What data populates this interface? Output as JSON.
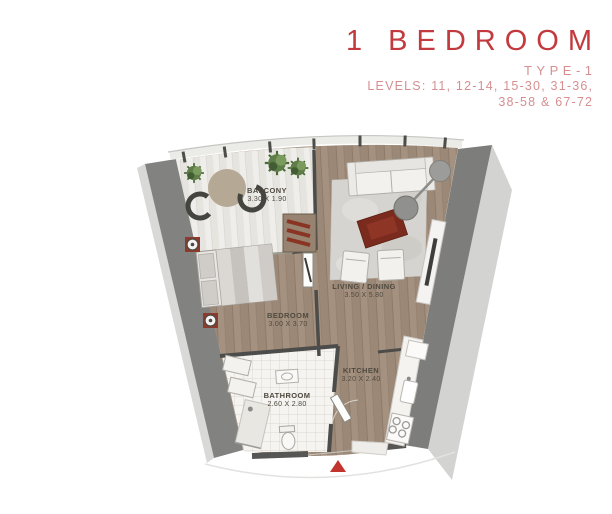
{
  "header": {
    "title": "1 BEDROOM",
    "type_label": "TYPE-1",
    "levels_line1": "LEVELS: 11, 12-14, 15-30, 31-36,",
    "levels_line2": "38-58 & 67-72"
  },
  "floorplan": {
    "rooms": [
      {
        "id": "balcony",
        "name": "BALCONY",
        "dims": "3.30 X 1.90"
      },
      {
        "id": "living-dining",
        "name": "LIVING / DINING",
        "dims": "3.50 X 5.80"
      },
      {
        "id": "bedroom",
        "name": "BEDROOM",
        "dims": "3.00 X 3.70"
      },
      {
        "id": "bathroom",
        "name": "BATHROOM",
        "dims": "2.60 X 2.80"
      },
      {
        "id": "kitchen",
        "name": "KITCHEN",
        "dims": "3.20 X 2.40"
      }
    ],
    "icons": {
      "entrance_arrow": "triangle-up"
    },
    "colors": {
      "title_red": "#c23a3e",
      "subtitle_pink": "#d68f91",
      "wall_dark": "#7f7f7d",
      "wood_floor": "#a5917f",
      "balcony_plank": "#efeeea",
      "tile_white": "#f5f4f1",
      "accent_red": "#8c3a2b",
      "entrance_arrow_red": "#c2342e"
    }
  }
}
